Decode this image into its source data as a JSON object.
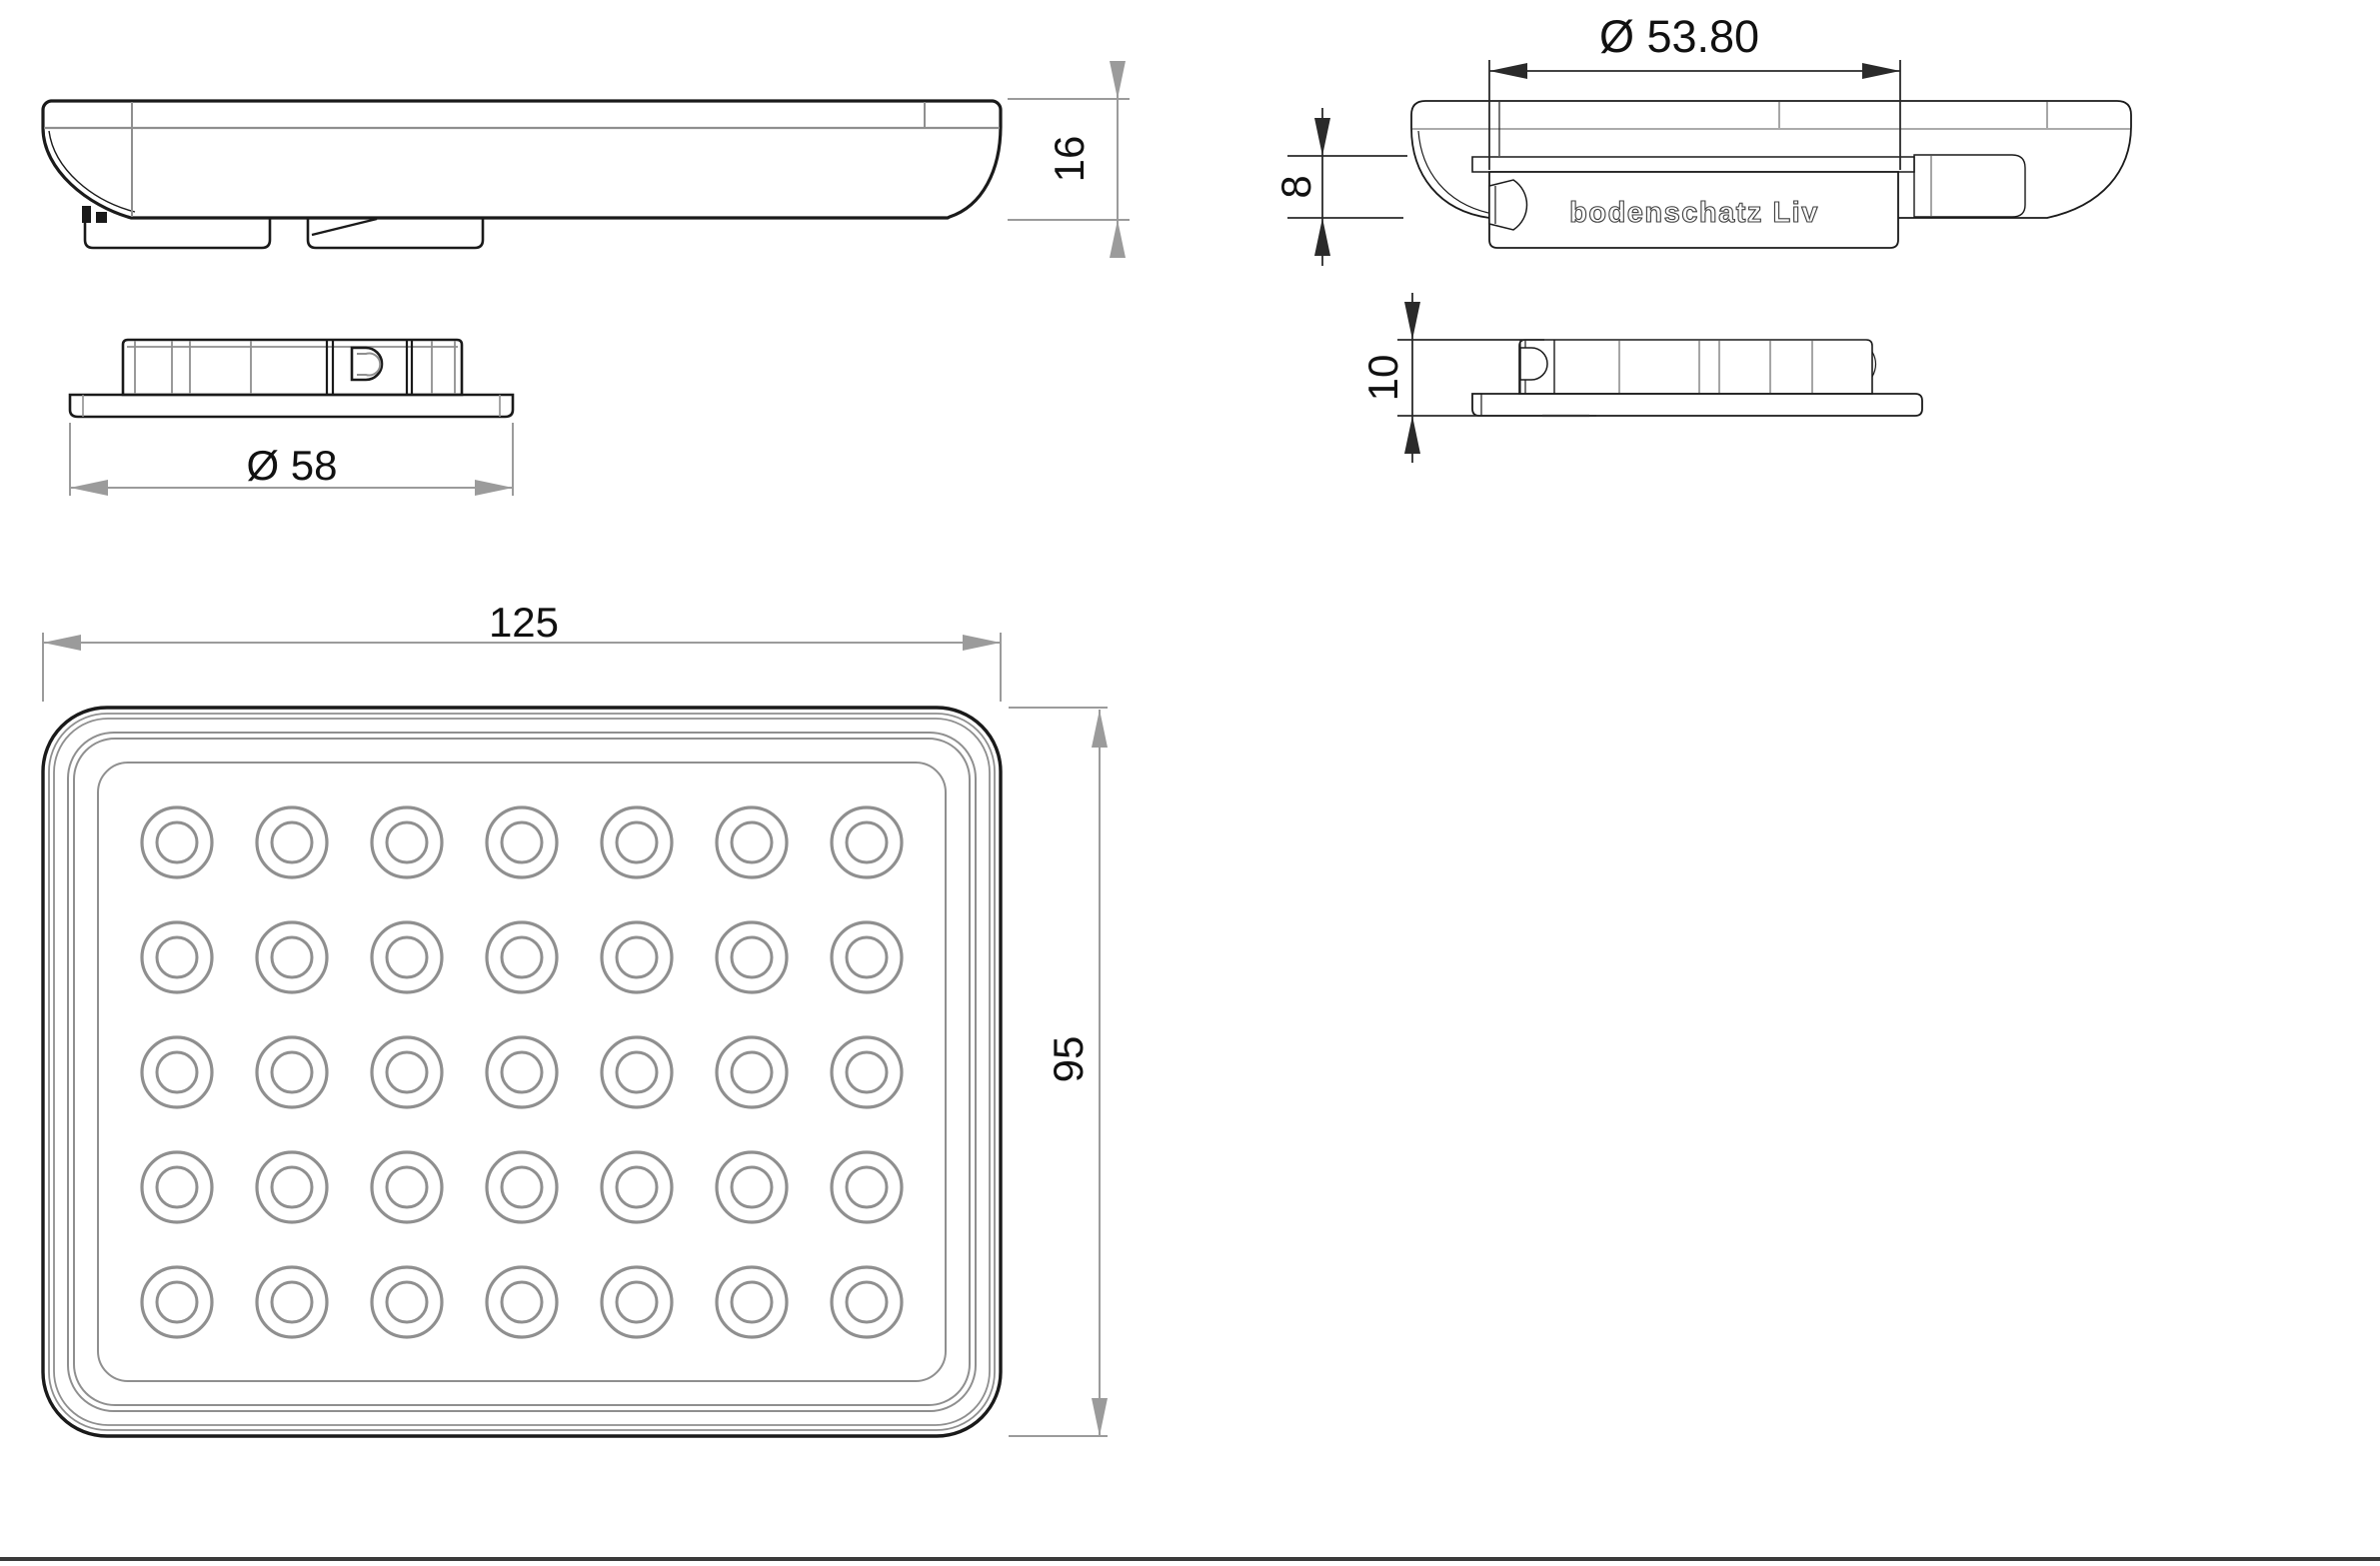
{
  "dimensions": {
    "plan_width": "125",
    "plan_height": "95",
    "side_height": "16",
    "plate_diameter": "Ø 58",
    "flange_diameter": "Ø 53.80",
    "bowl_depth": "8",
    "plate_height": "10"
  },
  "logo": {
    "text": "bodenschatz Liv"
  },
  "plan_view": {
    "hole_grid": {
      "columns": 7,
      "rows": 5
    }
  },
  "colors": {
    "line_black": "#1a1a1a",
    "line_gray": "#8f8f8f",
    "dim_gray": "#9b9b9b",
    "dim_black": "#2a2a2a",
    "logo_stroke": "#3c3c3c",
    "background": "#ffffff"
  }
}
